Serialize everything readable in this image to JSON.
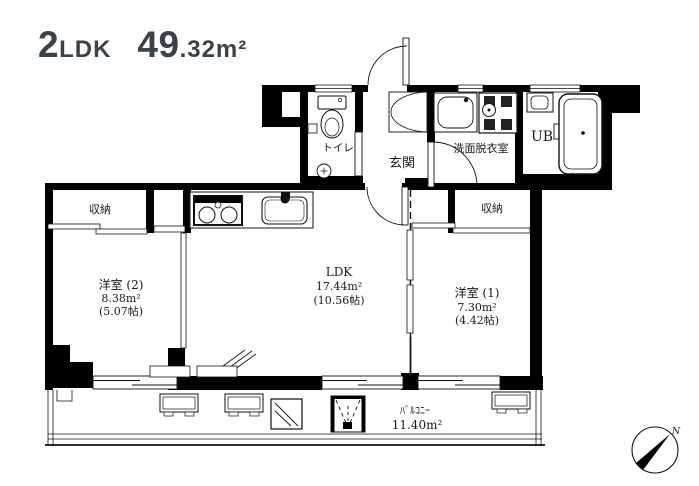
{
  "title": {
    "layout_big": "2",
    "layout_small": "LDK",
    "area_big": "49",
    "area_small": ".32m²"
  },
  "plan": {
    "toilet_label": "トイレ",
    "entrance_label": "玄関",
    "washroom_label": "洗面脱衣室",
    "unit_bath_label": "UB",
    "closet_left_label": "収納",
    "closet_right_label": "収納",
    "western_room_2": {
      "name": "洋室 (2)",
      "area": "8.38m²",
      "tatami": "(5.07帖)"
    },
    "ldk": {
      "name": "LDK",
      "area": "17.44m²",
      "tatami": "(10.56帖)"
    },
    "western_room_1": {
      "name": "洋室 (1)",
      "area": "7.30m²",
      "tatami": "(4.42帖)"
    },
    "balcony": {
      "name": "ﾊﾞﾙｺﾆｰ",
      "area": "11.40m²"
    }
  },
  "compass": {
    "north_label": "N"
  },
  "colors": {
    "wall": "#000000",
    "background": "#ffffff",
    "title_text": "#3b434a"
  }
}
